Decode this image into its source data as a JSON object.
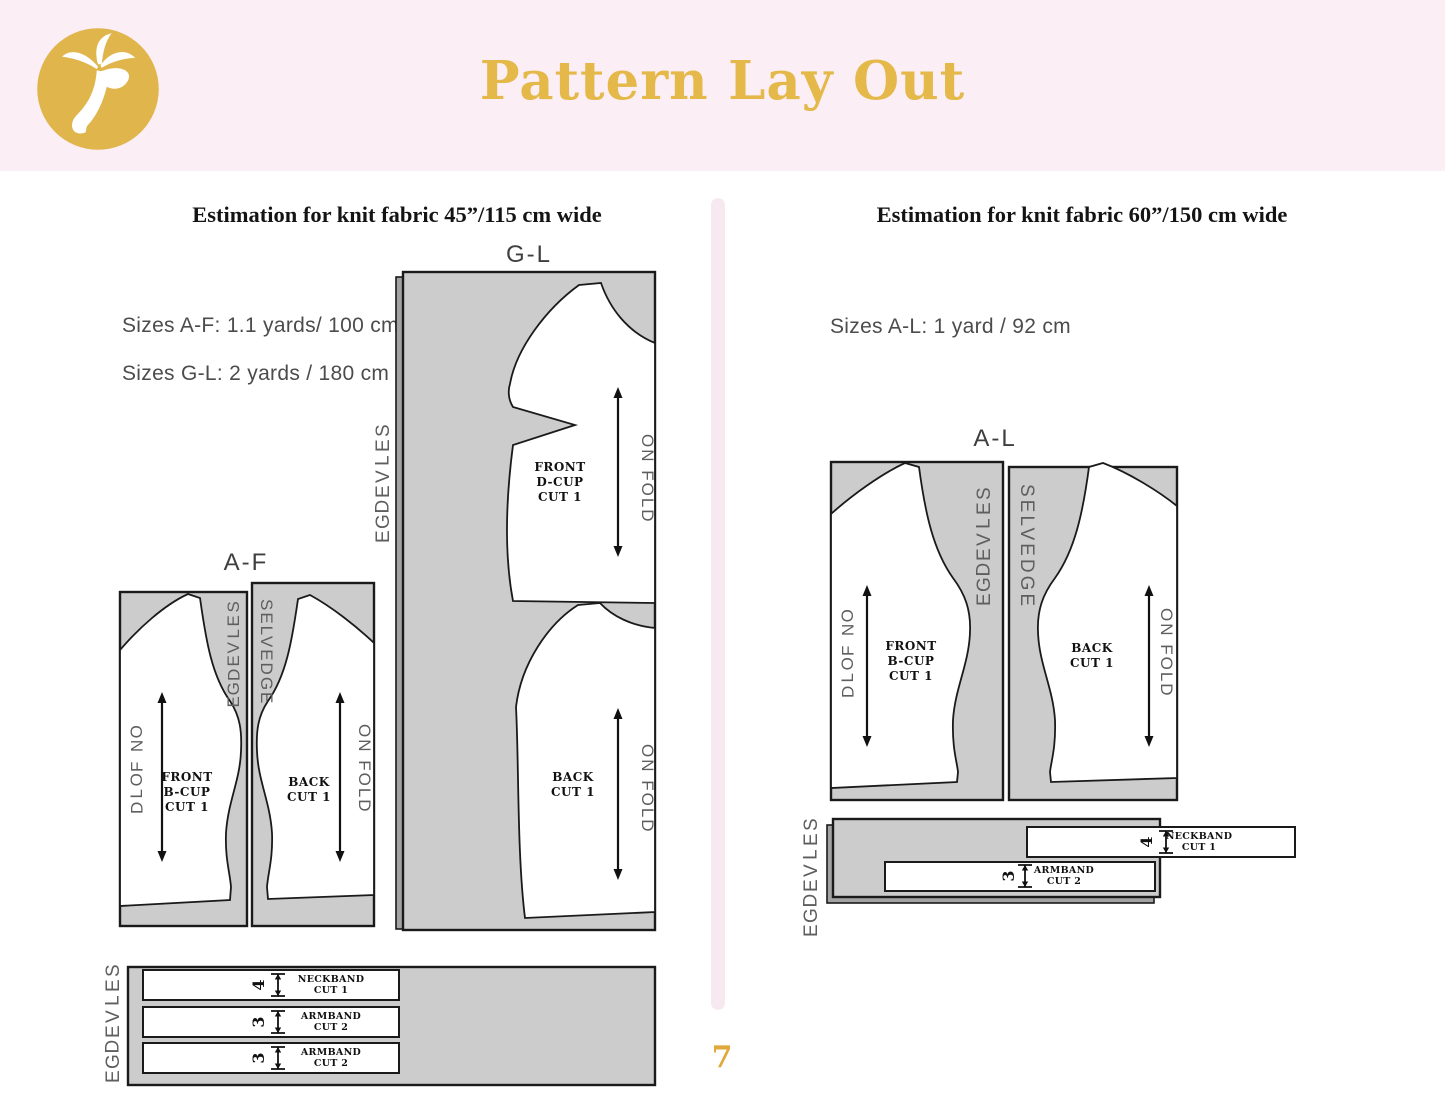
{
  "header": {
    "title": "Pattern Lay Out",
    "logo": "palm-tree-monogram"
  },
  "page_number": "7",
  "left": {
    "heading": "Estimation for knit fabric 45”/115 cm wide",
    "size_notes": [
      "Sizes A-F: 1.1 yards/ 100 cm",
      "Sizes G-L: 2 yards / 180 cm"
    ],
    "gl": {
      "label": "G-L",
      "selvedge": "SELVEDGE",
      "front": {
        "lines": [
          "FRONT",
          "D-CUP",
          "CUT 1"
        ],
        "on_fold": "ON FOLD"
      },
      "back": {
        "lines": [
          "BACK",
          "CUT 1"
        ],
        "on_fold": "ON FOLD"
      }
    },
    "af": {
      "label": "A-F",
      "selvedge_left": "SELVEDGE",
      "selvedge_right": "SELVEDGE",
      "front": {
        "lines": [
          "FRONT",
          "B-CUP",
          "CUT 1"
        ],
        "on_fold": "ON FOLD"
      },
      "back": {
        "lines": [
          "BACK",
          "CUT 1"
        ],
        "on_fold": "ON FOLD"
      }
    },
    "strips": {
      "selvedge": "SELVEDGE",
      "items": [
        {
          "width_num": "4",
          "lines": [
            "NECKBAND",
            "CUT 1"
          ]
        },
        {
          "width_num": "3",
          "lines": [
            "ARMBAND",
            "CUT 2"
          ]
        },
        {
          "width_num": "3",
          "lines": [
            "ARMBAND",
            "CUT 2"
          ]
        }
      ]
    }
  },
  "right": {
    "heading": "Estimation for knit fabric 60”/150 cm wide",
    "size_notes": [
      "Sizes A-L: 1 yard / 92 cm"
    ],
    "al": {
      "label": "A-L",
      "selvedge_left": "SELVEDGE",
      "selvedge_right": "SELVEDGE",
      "front": {
        "lines": [
          "FRONT",
          "B-CUP",
          "CUT 1"
        ],
        "on_fold": "ON FOLD"
      },
      "back": {
        "lines": [
          "BACK",
          "CUT 1"
        ],
        "on_fold": "ON FOLD"
      }
    },
    "strips": {
      "selvedge": "SELVEDGE",
      "items": [
        {
          "width_num": "4",
          "lines": [
            "NECKBAND",
            "CUT 1"
          ]
        },
        {
          "width_num": "3",
          "lines": [
            "ARMBAND",
            "CUT 2"
          ]
        }
      ]
    }
  },
  "colors": {
    "gold": "#e5b84a",
    "header_pink": "#fbeff5",
    "divider_pink": "#f7e9f0",
    "fabric_gray": "#cccccc",
    "outline": "#1a1a1a"
  }
}
